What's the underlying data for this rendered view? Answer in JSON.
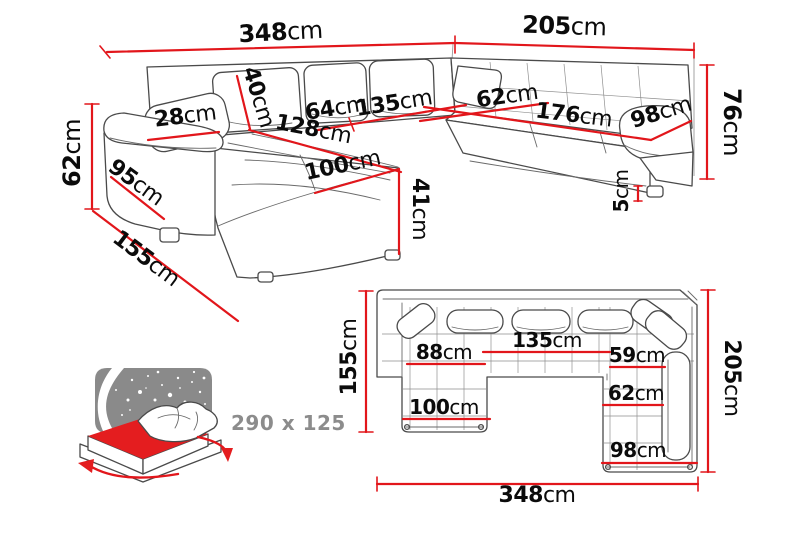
{
  "diagram_type": "corner-sofa-dimension-diagram",
  "colors": {
    "dimension_red": "#e2161b",
    "sofa_outline": "#4a4a4a",
    "label_black": "#0b0b0b",
    "bed_text_gray": "#8c8c8c",
    "bed_mattress_red": "#e41d1f",
    "bed_panel_gray": "#8a8a8a",
    "background": "#ffffff"
  },
  "perspective_view": {
    "description": "3D perspective view of U-shaped corner sofa",
    "dims": {
      "total_width": {
        "value": "348",
        "unit": "cm"
      },
      "right_length": {
        "value": "205",
        "unit": "cm"
      },
      "back_height": {
        "value": "76",
        "unit": "cm"
      },
      "left_height": {
        "value": "62",
        "unit": "cm"
      },
      "armrest_width": {
        "value": "28",
        "unit": "cm"
      },
      "back_cushion_height": {
        "value": "40",
        "unit": "cm"
      },
      "seat_depth_left": {
        "value": "64",
        "unit": "cm"
      },
      "seat_width_center": {
        "value": "135",
        "unit": "cm"
      },
      "seat_depth_corner": {
        "value": "62",
        "unit": "cm"
      },
      "seat_length_right": {
        "value": "176",
        "unit": "cm"
      },
      "right_armrest_width": {
        "value": "98",
        "unit": "cm"
      },
      "chaise_seat_length": {
        "value": "128",
        "unit": "cm"
      },
      "left_side_depth": {
        "value": "95",
        "unit": "cm"
      },
      "chaise_width": {
        "value": "100",
        "unit": "cm"
      },
      "seat_height": {
        "value": "41",
        "unit": "cm"
      },
      "leg_height": {
        "value": "5",
        "unit": "cm"
      },
      "chaise_total_length": {
        "value": "155",
        "unit": "cm"
      }
    }
  },
  "top_view": {
    "description": "Top-down plan view of U-shaped corner sofa",
    "dims": {
      "chaise_total_length": {
        "value": "155",
        "unit": "cm"
      },
      "right_length": {
        "value": "205",
        "unit": "cm"
      },
      "total_width": {
        "value": "348",
        "unit": "cm"
      },
      "seat_left": {
        "value": "88",
        "unit": "cm"
      },
      "seat_center": {
        "value": "135",
        "unit": "cm"
      },
      "seat_right": {
        "value": "59",
        "unit": "cm"
      },
      "right_seat_width": {
        "value": "62",
        "unit": "cm"
      },
      "chaise_seat_width": {
        "value": "100",
        "unit": "cm"
      },
      "right_end_width": {
        "value": "98",
        "unit": "cm"
      }
    }
  },
  "bed_function": {
    "description": "sleeping function icon",
    "sleeping_area": "290 x 125"
  }
}
